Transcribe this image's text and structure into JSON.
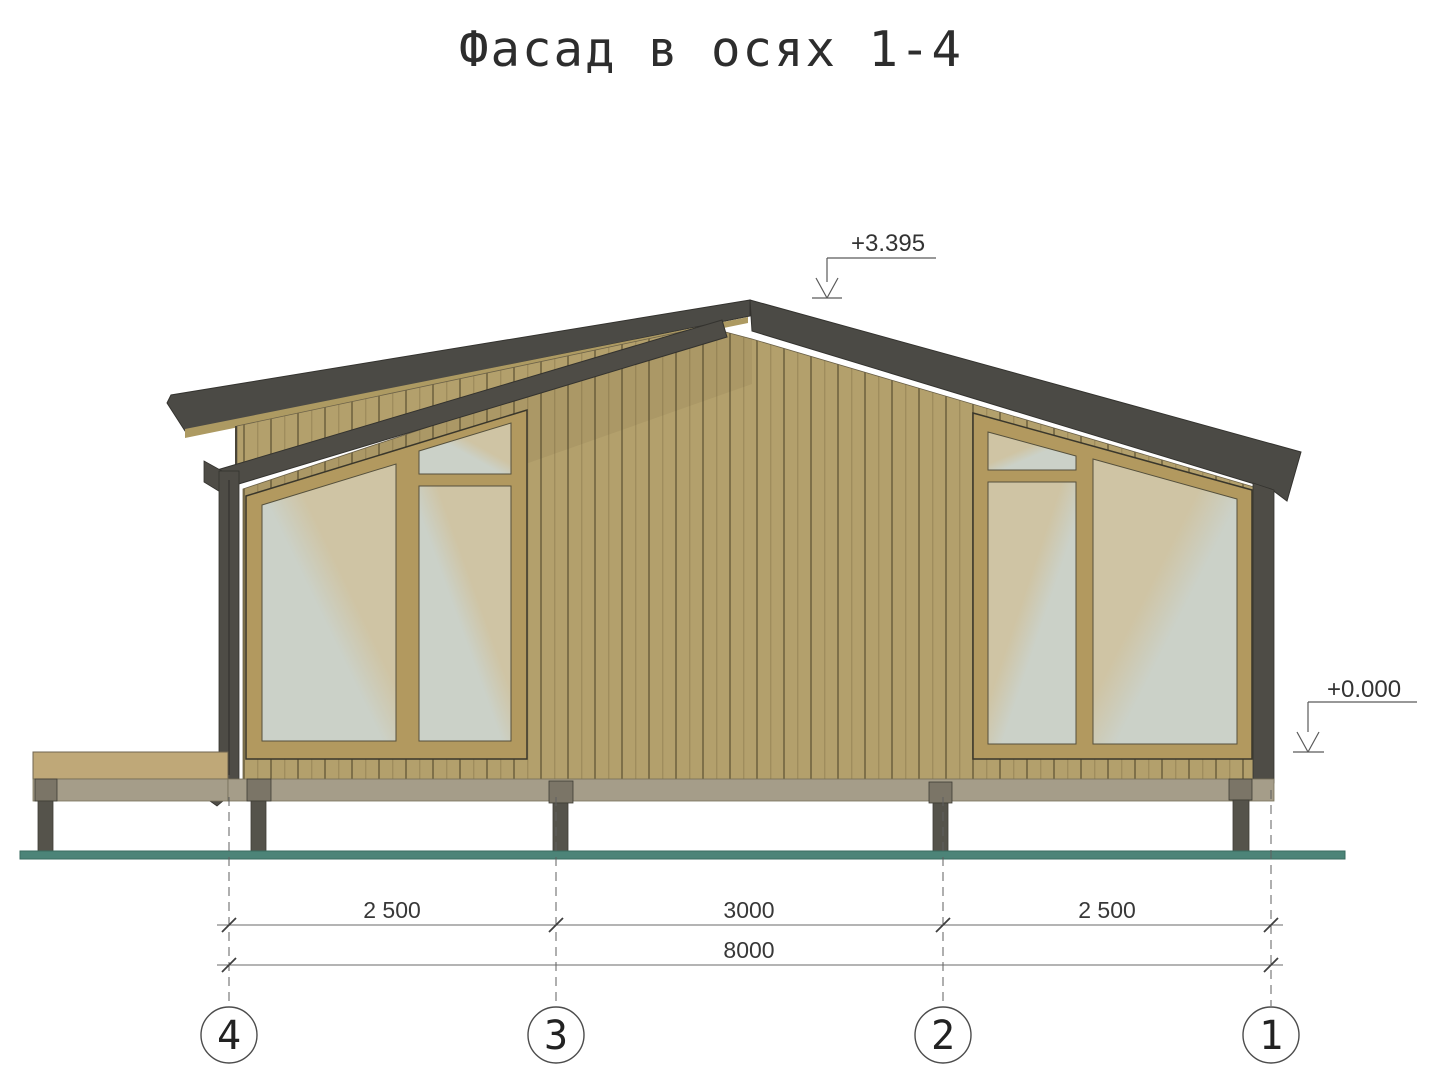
{
  "title": "Фасад в осях 1-4",
  "elevation_markers": {
    "ridge": {
      "label": "+3.395"
    },
    "ground": {
      "label": "+0.000"
    }
  },
  "dimensions": {
    "row1": [
      {
        "label": "2 500"
      },
      {
        "label": "3000"
      },
      {
        "label": "2 500"
      }
    ],
    "row2": [
      {
        "label": "8000"
      }
    ]
  },
  "axes": [
    {
      "label": "4"
    },
    {
      "label": "3"
    },
    {
      "label": "2"
    },
    {
      "label": "1"
    }
  ],
  "colors": {
    "siding": "#b3a06c",
    "window_frame": "#b2995f",
    "roof": "#4b4a45",
    "trim": "#4e4c46",
    "glass_gray": "#cbd1c8",
    "glass_beige": "#cfc4a4",
    "deck": "#bfa878",
    "floor_band": "#a59d89",
    "post": "#55534b",
    "post_cap": "#7b7567",
    "ground": "#4c8478"
  }
}
